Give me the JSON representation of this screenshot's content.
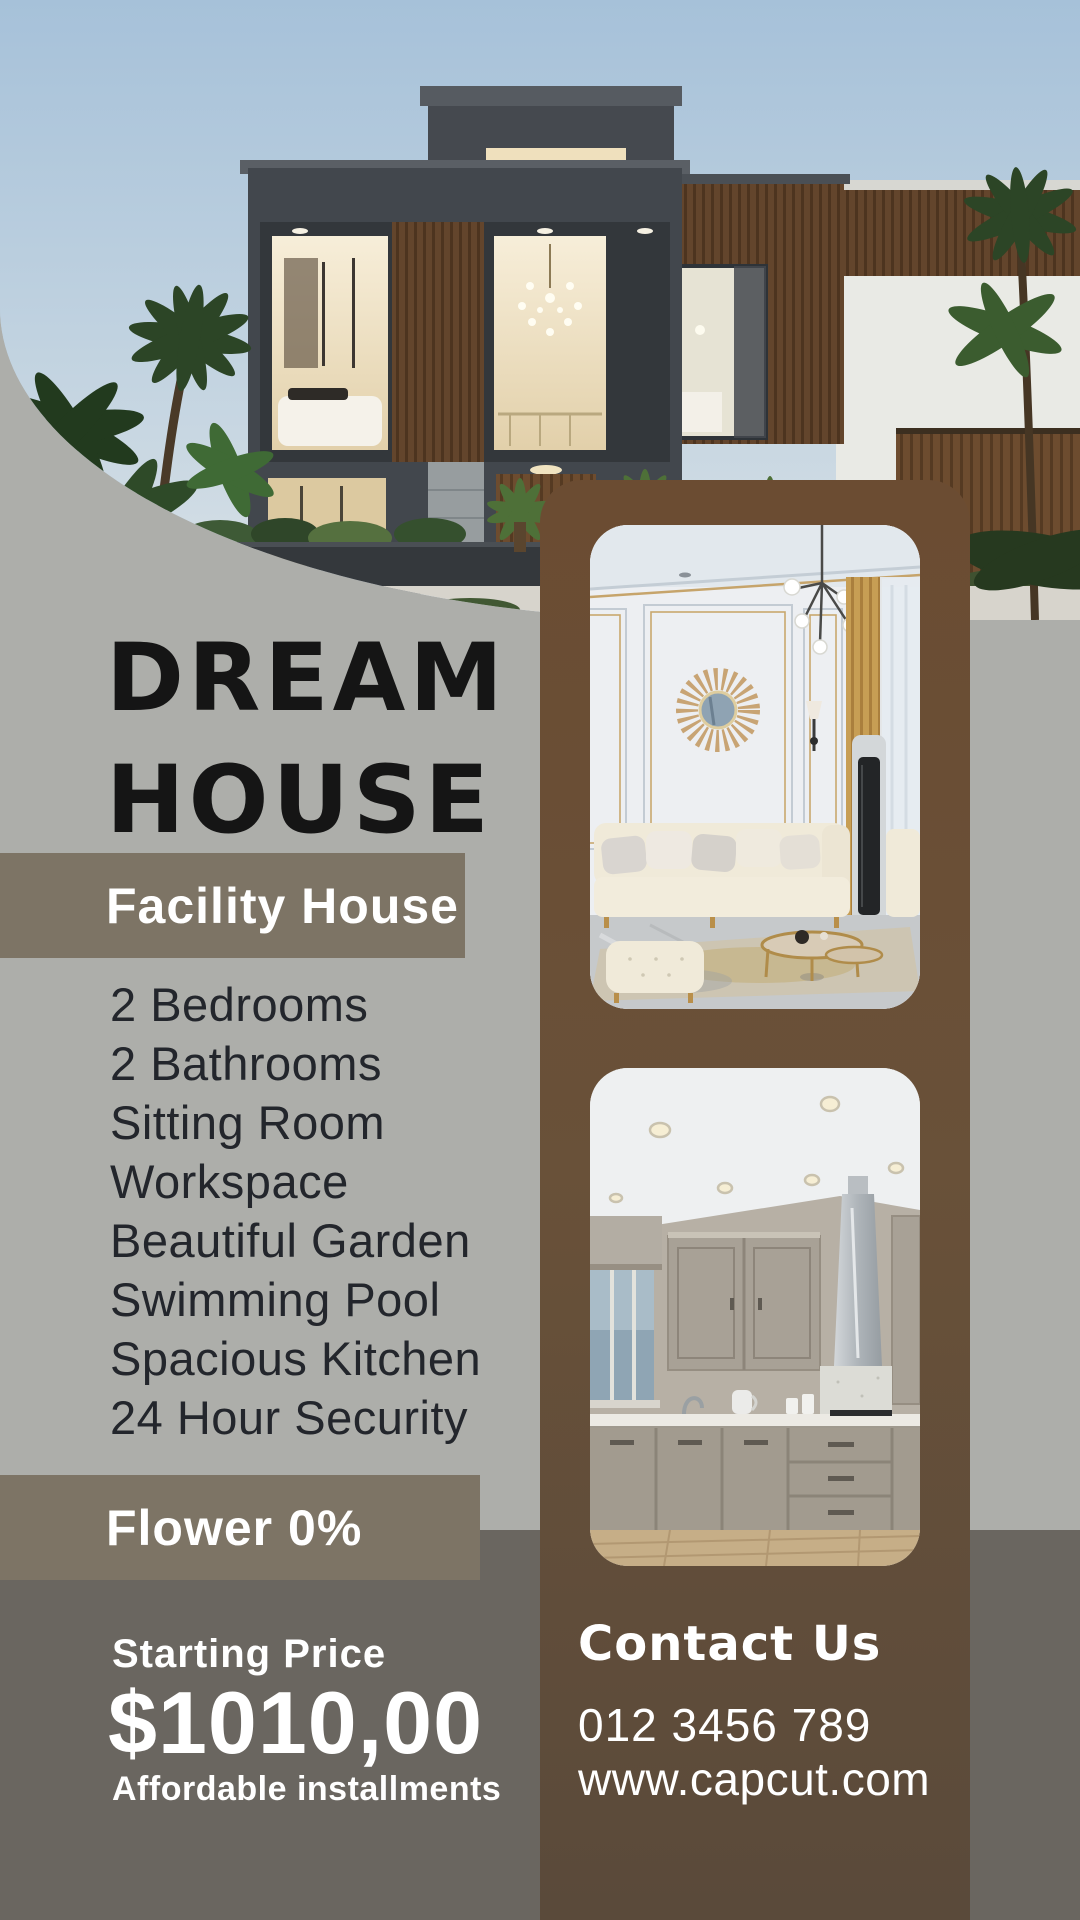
{
  "poster": {
    "title": {
      "line1": "DREAM",
      "line2": "HOUSE"
    },
    "facility": {
      "header": "Facility House",
      "items": [
        "2 Bedrooms",
        "2 Bathrooms",
        "Sitting Room",
        "Workspace",
        "Beautiful Garden",
        "Swimming Pool",
        "Spacious Kitchen",
        "24 Hour Security"
      ]
    },
    "flower_band": {
      "label": "Flower 0%"
    },
    "pricing": {
      "label": "Starting Price",
      "price": "$1010,00",
      "note": "Affordable installments"
    },
    "contact": {
      "heading": "Contact Us",
      "phone": "012 3456 789",
      "website": "www.capcut.com"
    },
    "images": {
      "hero_alt": "Modern two-story charcoal and wood house with palm trees at dusk",
      "living_alt": "Elegant living room with cream sofa, gold sunburst mirror and chandelier",
      "kitchen_alt": "Modern grey kitchen with steel hood and wooden floor"
    },
    "colors": {
      "background": "#adaeaa",
      "band_taupe": "#7d7465",
      "panel_brown_top": "#6b4c32",
      "panel_brown_bottom": "#5a4a3a",
      "bottom_band": "#6a6660",
      "title_black": "#151515",
      "list_text": "#23262c",
      "white": "#ffffff"
    }
  }
}
